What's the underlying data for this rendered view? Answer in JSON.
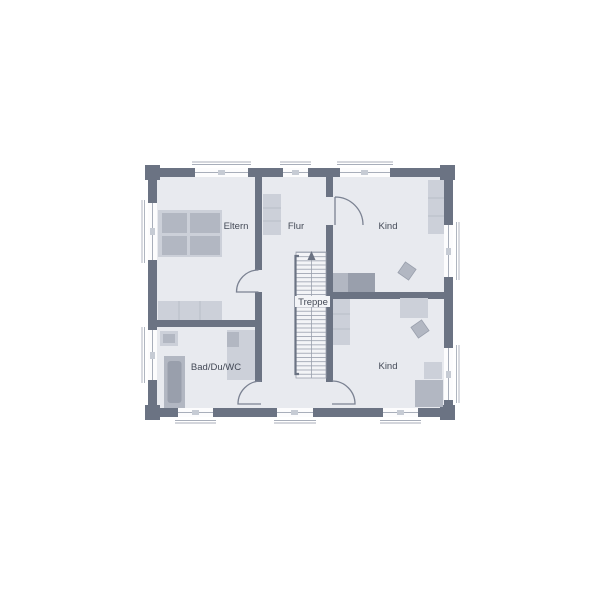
{
  "plan": {
    "type": "floor-plan",
    "rooms": [
      {
        "id": "eltern",
        "label": "Eltern"
      },
      {
        "id": "flur",
        "label": "Flur"
      },
      {
        "id": "kind-oben",
        "label": "Kind"
      },
      {
        "id": "treppe",
        "label": "Treppe"
      },
      {
        "id": "bad-du-wc",
        "label": "Bad/Du/WC"
      },
      {
        "id": "kind-unten",
        "label": "Kind"
      }
    ]
  },
  "colors": {
    "wall": "#6b7383",
    "floor": "#e8eaef",
    "window_fill": "#fcfcfd",
    "window_line": "#a8aeba",
    "window_marker": "#c6cbd4",
    "door_line": "#7b8292",
    "stair_fill": "#f3f4f7",
    "stair_line": "#9aa0ad",
    "furniture_light": "#ccd0d9",
    "furniture_medium": "#b2b7c2",
    "furniture_dark": "#999fac",
    "furniture_divider": "#b9bec8",
    "label_text": "#434956"
  }
}
